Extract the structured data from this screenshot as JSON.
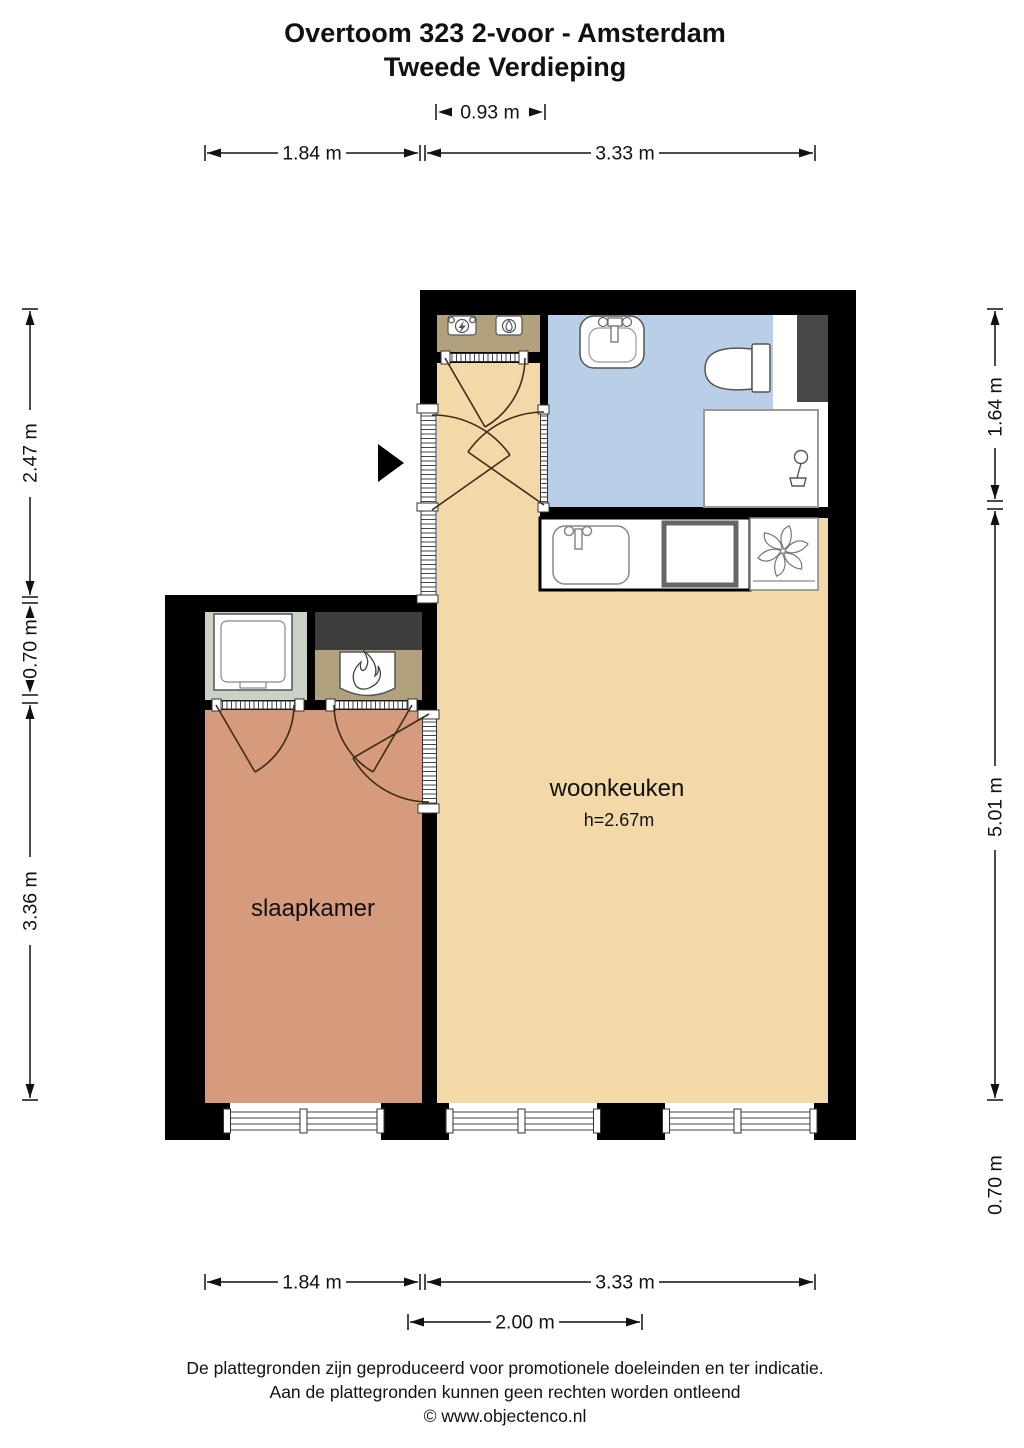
{
  "title": {
    "line1": "Overtoom 323 2-voor - Amsterdam",
    "line2": "Tweede Verdieping"
  },
  "rooms": {
    "woonkeuken": {
      "label": "woonkeuken",
      "ceiling_height": "h=2.67m"
    },
    "slaapkamer": {
      "label": "slaapkamer"
    }
  },
  "dimensions": {
    "top_hall_width": "0.93 m",
    "top_bedroom_width": "1.84 m",
    "top_living_width": "3.33 m",
    "left_hall_depth": "2.47 m",
    "left_closet_depth": "0.70 m",
    "left_bedroom_depth": "3.36 m",
    "right_bathroom_depth": "1.64 m",
    "right_living_depth": "5.01 m",
    "right_lower_depth": "0.70 m",
    "bottom_bedroom_width": "1.84 m",
    "bottom_living_width": "3.33 m",
    "bottom_window_width": "2.00 m"
  },
  "footer": {
    "line1": "De plattegronden zijn geproduceerd voor promotionele doeleinden en ter indicatie.",
    "line2": "Aan de plattegronden kunnen geen rechten worden ontleend",
    "line3": "© www.objectenco.nl"
  },
  "colors": {
    "wall": "#000000",
    "floor_living": "#f2d9a7",
    "floor_bedroom": "#d69a7c",
    "floor_bathroom": "#b9cfe8",
    "floor_laundry_closet": "#c9d2c5",
    "floor_utility": "#b2a17d",
    "shaft_grey": "#474747",
    "door_arc": "#3f2d1a"
  },
  "icons": {
    "entrance": "entrance-arrow-icon",
    "electric_meter": "electric-meter-icon",
    "water_meter": "water-meter-icon",
    "boiler": "boiler-flame-icon",
    "ventilation": "ventilation-fan-icon",
    "shower": "shower-head-icon"
  }
}
